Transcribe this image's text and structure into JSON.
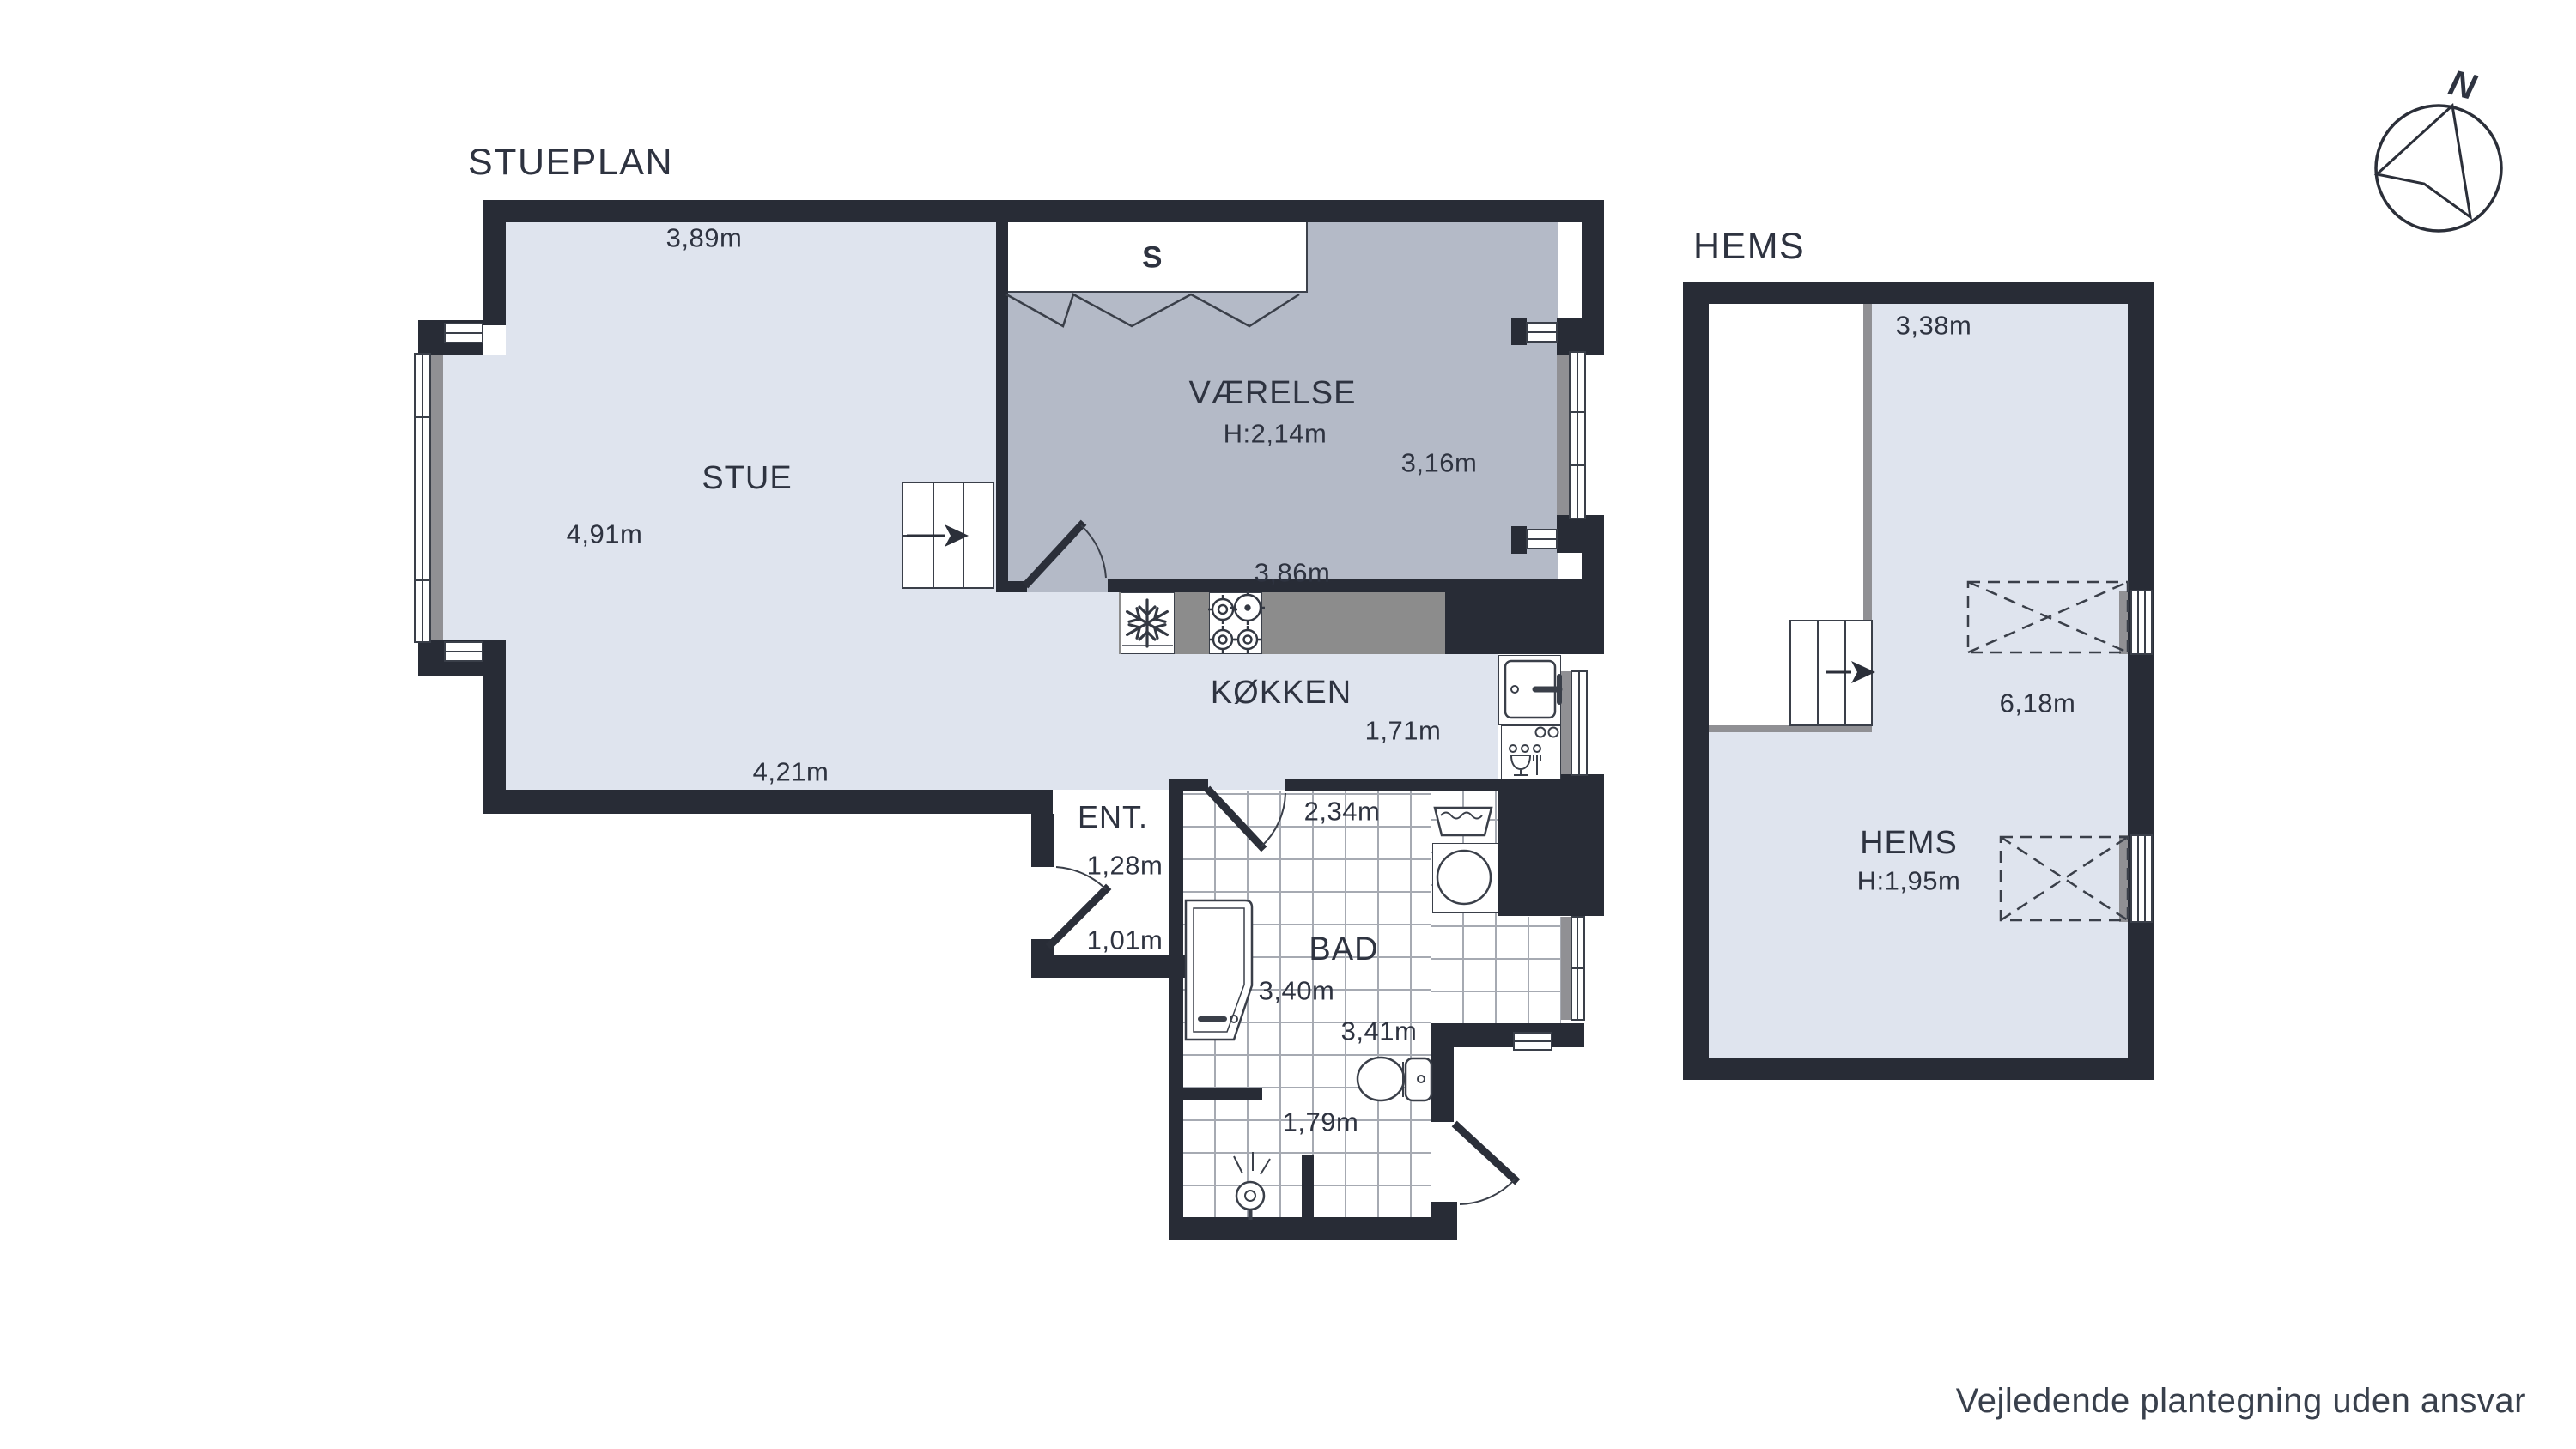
{
  "plan": {
    "title": "STUEPLAN",
    "rooms": {
      "stue": {
        "name": "STUE",
        "top_width": "3,89m",
        "side_depth": "4,91m",
        "bottom_width": "4,21m"
      },
      "vaerelse": {
        "name": "VÆRELSE",
        "ceiling_height": "H:2,14m",
        "side_depth": "3,16m",
        "bottom_width": "3,86m",
        "closet_label": "S"
      },
      "koekken": {
        "name": "KØKKEN",
        "depth": "1,71m"
      },
      "ent": {
        "name": "ENT.",
        "width_upper": "1,28m",
        "width_lower": "1,01m"
      },
      "bad": {
        "name": "BAD",
        "top_width": "2,34m",
        "mid_width": "3,40m",
        "lower_width": "3,41m",
        "bottom_width": "1,79m"
      }
    }
  },
  "hems": {
    "title": "HEMS",
    "room": {
      "name": "HEMS",
      "ceiling_height": "H:1,95m",
      "top_width": "3,38m",
      "side_depth": "6,18m"
    }
  },
  "compass": {
    "north_label": "N"
  },
  "footer": {
    "disclaimer": "Vejledende plantegning uden ansvar"
  },
  "icons": [
    "freezer-snowflake-icon",
    "cooktop-burners-icon",
    "kitchen-sink-icon",
    "dishwasher-icon",
    "laundry-tub-icon",
    "washing-machine-icon",
    "toilet-icon",
    "shower-stall-icon",
    "shower-head-icon",
    "stairs-arrow-icon",
    "skylight-cross-icon",
    "compass-north-icon"
  ],
  "colors": {
    "wall": "#282c36",
    "floor_light": "#dfe4ee",
    "floor_room": "#b4bac7",
    "counter": "#8c8c8c",
    "sill": "#909094",
    "tile_line": "#a6aab2",
    "text": "#2e3340"
  }
}
